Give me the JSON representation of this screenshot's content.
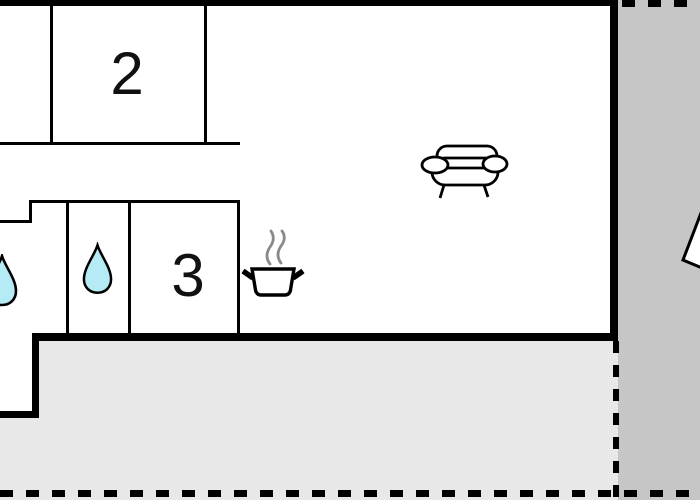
{
  "floorplan": {
    "title": "holiday home floor plan",
    "rooms": [
      {
        "name": "bedroom-2",
        "label": "2"
      },
      {
        "name": "room-3",
        "label": "3"
      }
    ],
    "icons": [
      "water-drop-icon",
      "water-drop-icon",
      "cooking-pot-icon",
      "steam-icon",
      "sofa-icon",
      "parasol-fragment-icon"
    ],
    "areas": {
      "terrace_bottom": "terrace",
      "patio_right": "patio"
    },
    "colors": {
      "wall": "#000000",
      "room_fill": "#ffffff",
      "patio_bottom_fill": "#e8e8e8",
      "patio_right_fill": "#c6c6c6",
      "water_drop_fill": "#b5ebf4",
      "steam_stroke": "#8a8a8a"
    }
  }
}
